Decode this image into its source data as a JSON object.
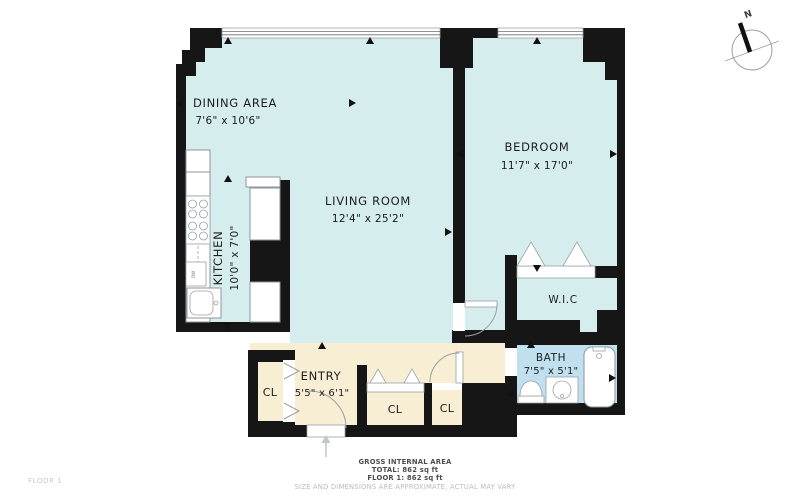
{
  "page": {
    "floor_label": "FLOOR 1"
  },
  "colors": {
    "wall": "#161616",
    "room": "#d6eded",
    "entry": "#f7eed3",
    "bath": "#c0e0f0",
    "fixture_stroke": "#8d969c",
    "footer_text": "#4d4d4d",
    "footer_muted": "#b9bcbf"
  },
  "rooms": {
    "dining": {
      "name": "DINING AREA",
      "dims": "7'6\" x 10'6\""
    },
    "living": {
      "name": "LIVING ROOM",
      "dims": "12'4\" x 25'2\""
    },
    "kitchen": {
      "name": "KITCHEN",
      "dims": "10'0\" x 7'0\""
    },
    "bedroom": {
      "name": "BEDROOM",
      "dims": "11'7\" x 17'0\""
    },
    "wic": {
      "name": "W.I.C"
    },
    "bath": {
      "name": "BATH",
      "dims": "7'5\" x 5'1\""
    },
    "entry": {
      "name": "ENTRY",
      "dims": "5'5\" x 6'1\""
    },
    "closet1": {
      "name": "CL"
    },
    "closet2": {
      "name": "CL"
    },
    "closet3": {
      "name": "CL"
    }
  },
  "fixtures": {
    "dishwasher": "DW"
  },
  "compass": {
    "label": "N"
  },
  "footer": {
    "line1": "GROSS INTERNAL AREA",
    "line2": "TOTAL: 862 sq ft",
    "line3": "FLOOR 1: 862 sq ft",
    "disclaimer": "SIZE AND DIMENSIONS ARE APPROXIMATE, ACTUAL MAY VARY"
  }
}
